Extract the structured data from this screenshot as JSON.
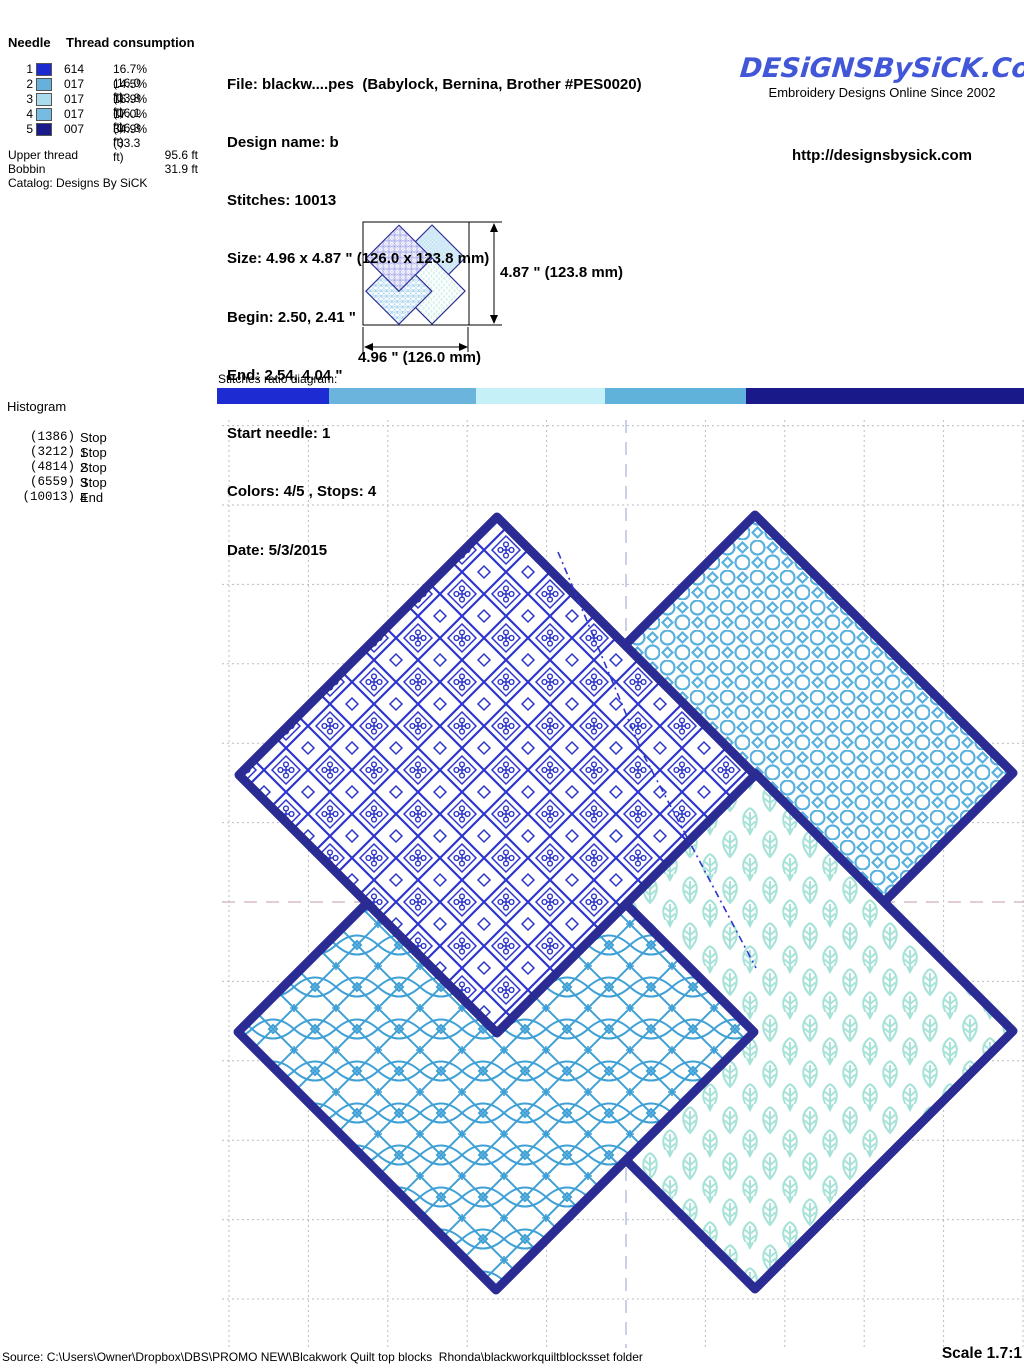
{
  "header": {
    "needle_table": {
      "col_needle": "Needle",
      "col_thread": "Thread consumption",
      "rows": [
        {
          "num": "1",
          "color": "#1c2ad0",
          "code": "614",
          "usage": "16.7% (16.0 ft)"
        },
        {
          "num": "2",
          "color": "#66b0dc",
          "code": "017",
          "usage": "14.5% (13.8 ft)"
        },
        {
          "num": "3",
          "color": "#aadcee",
          "code": "017",
          "usage": "16.9% (16.1 ft)"
        },
        {
          "num": "4",
          "color": "#76bce2",
          "code": "017",
          "usage": "17.0% (16.3 ft)"
        },
        {
          "num": "5",
          "color": "#1a1a8c",
          "code": "007",
          "usage": "34.9% (33.3 ft)"
        }
      ],
      "upper_thread_label": "Upper thread",
      "upper_thread_value": "95.6 ft",
      "bobbin_label": "Bobbin",
      "bobbin_value": "31.9 ft",
      "catalog": "Catalog: Designs By SiCK"
    },
    "info_lines": [
      "File: blackw....pes  (Babylock, Bernina, Brother #PES0020)",
      "Design name: b",
      "Stitches: 10013",
      "Size: 4.96 x 4.87 \" (126.0 x 123.8 mm)",
      "Begin: 2.50, 2.41 \"",
      "End: 2.54, 4.04 \"",
      "Start needle: 1",
      "Colors: 4/5 , Stops: 4",
      "Date: 5/3/2015"
    ],
    "logo": {
      "title": "DESiGNSBySiCK.CoM",
      "tagline": "Embroidery Designs Online Since 2002",
      "url": "http://designsbysick.com",
      "color": "#4157d8"
    }
  },
  "thumbnail": {
    "height_label": "4.87 \" (123.8 mm)",
    "width_label": "4.96 \" (126.0 mm)"
  },
  "ratio": {
    "label": "Stitches ratio diagram:",
    "segments": [
      {
        "stitches": 1386,
        "color": "#1d2bd2"
      },
      {
        "stitches": 1826,
        "color": "#6ab4de"
      },
      {
        "stitches": 1602,
        "color": "#c6f0f8"
      },
      {
        "stitches": 1745,
        "color": "#60b2da"
      },
      {
        "stitches": 3454,
        "color": "#19198a"
      }
    ]
  },
  "histogram": {
    "title": "Histogram",
    "rows": [
      {
        "count": "(1386)",
        "label": "Stop 1"
      },
      {
        "count": "(3212)",
        "label": "Stop 2"
      },
      {
        "count": "(4814)",
        "label": "Stop 3"
      },
      {
        "count": "(6559)",
        "label": "Stop 4"
      },
      {
        "count": "(10013)",
        "label": "End"
      }
    ]
  },
  "design": {
    "border_color": "#2b2b94",
    "blocks": [
      {
        "name": "top-left",
        "pattern": "hearts-lattice",
        "color": "#2c35cc"
      },
      {
        "name": "top-right",
        "pattern": "ring-lattice",
        "color": "#58b0de"
      },
      {
        "name": "bottom-left",
        "pattern": "star-lattice",
        "color": "#3fa0d6"
      },
      {
        "name": "bottom-right",
        "pattern": "leaf-lattice",
        "color": "#a6e2d8"
      }
    ]
  },
  "footer": {
    "source": "Source: C:\\Users\\Owner\\Dropbox\\DBS\\PROMO NEW\\Blcakwork Quilt top blocks  Rhonda\\blackworkquiltblocksset folder",
    "scale": "Scale 1.7:1"
  }
}
